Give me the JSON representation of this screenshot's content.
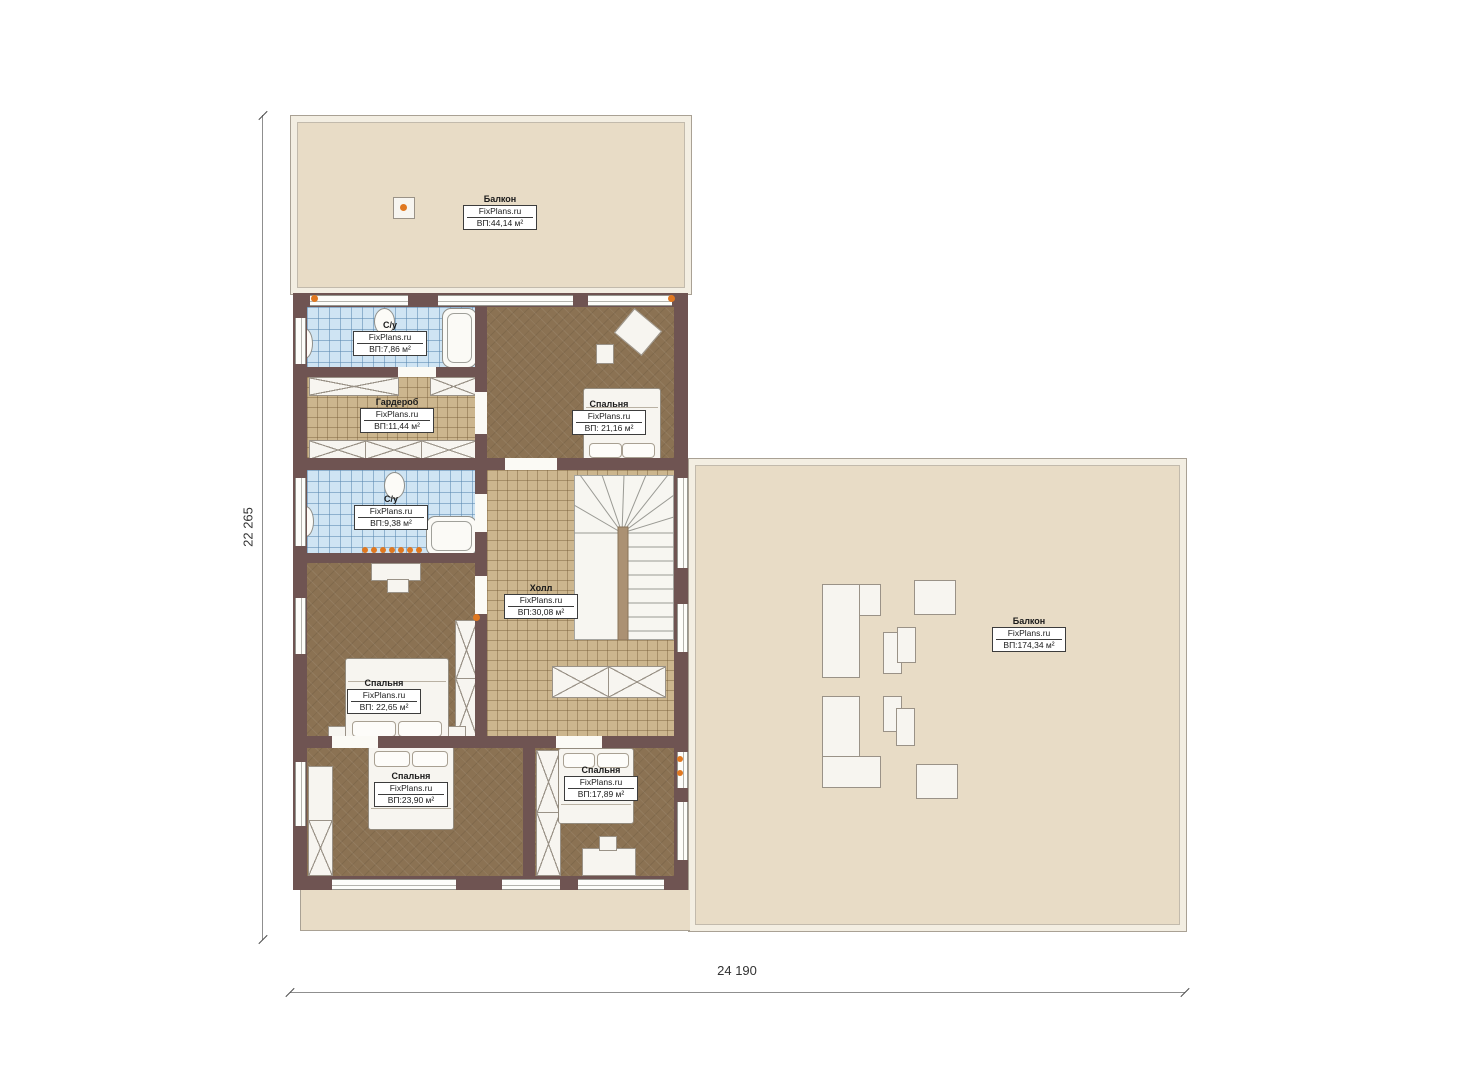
{
  "plan": {
    "title": "Floor plan — second level",
    "dimensions": {
      "vertical": "22 265",
      "horizontal": "24 190"
    },
    "colors": {
      "wall": "#6f5452",
      "balcony_floor": "#e8dcc6",
      "bedroom_floor": "#8b7253",
      "tile_floor": "#ccb68e",
      "bath_tile": "#cfe4f3",
      "accent_orange": "#e07820"
    },
    "rooms": [
      {
        "id": "balcony-top",
        "name": "Балкон",
        "brand": "FixPlans.ru",
        "area": "ВП:44,14 м²"
      },
      {
        "id": "su-top",
        "name": "С/у",
        "brand": "FixPlans.ru",
        "area": "ВП:7,86 м²"
      },
      {
        "id": "wardrobe",
        "name": "Гардероб",
        "brand": "FixPlans.ru",
        "area": "ВП:11,44 м²"
      },
      {
        "id": "bedroom-top",
        "name": "Спальня",
        "brand": "FixPlans.ru",
        "area": "ВП: 21,16 м²"
      },
      {
        "id": "su-mid",
        "name": "С/у",
        "brand": "FixPlans.ru",
        "area": "ВП:9,38 м²"
      },
      {
        "id": "hall",
        "name": "Холл",
        "brand": "FixPlans.ru",
        "area": "ВП:30,08 м²"
      },
      {
        "id": "balcony-right",
        "name": "Балкон",
        "brand": "FixPlans.ru",
        "area": "ВП:174,34 м²"
      },
      {
        "id": "bedroom-mid",
        "name": "Спальня",
        "brand": "FixPlans.ru",
        "area": "ВП: 22,65 м²"
      },
      {
        "id": "bedroom-bottom-left",
        "name": "Спальня",
        "brand": "FixPlans.ru",
        "area": "ВП:23,90 м²"
      },
      {
        "id": "bedroom-bottom-right",
        "name": "Спальня",
        "brand": "FixPlans.ru",
        "area": "ВП:17,89 м²"
      }
    ]
  }
}
